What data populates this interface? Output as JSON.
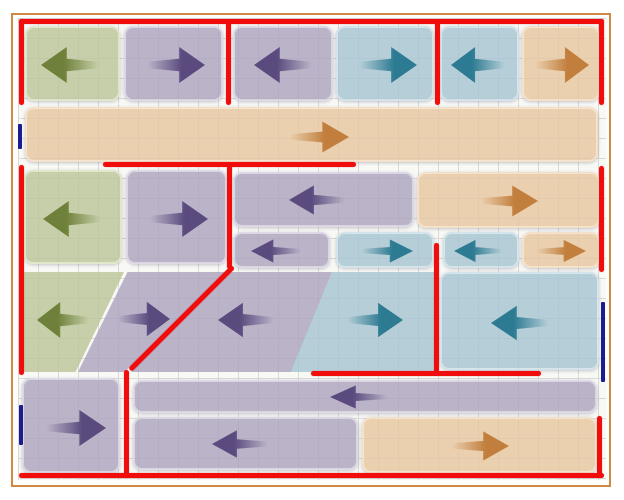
{
  "diagram": {
    "canvas": {
      "width": 624,
      "height": 500,
      "background": "#ffffff"
    },
    "frame": {
      "x": 11,
      "y": 13,
      "w": 600,
      "h": 474,
      "border_width": 2,
      "border_color": "#d08845",
      "fill": "#fdfdfb"
    },
    "grid": {
      "x": 18,
      "y": 18,
      "w": 588,
      "h": 462,
      "cell": 20,
      "line_color": "#d9d9d6",
      "background": "#f8f8f5"
    },
    "palette": {
      "green": {
        "fill": "rgba(187,198,152,0.82)",
        "edge": "rgba(226,236,202,0.95)",
        "arrow": "#6e8039"
      },
      "purple": {
        "fill": "rgba(173,163,190,0.82)",
        "edge": "rgba(224,220,234,0.95)",
        "arrow": "#5a4a7e"
      },
      "teal": {
        "fill": "rgba(167,197,210,0.82)",
        "edge": "rgba(211,230,236,0.95)",
        "arrow": "#2d7b92"
      },
      "orange": {
        "fill": "rgba(231,199,160,0.82)",
        "edge": "rgba(244,224,198,0.95)",
        "arrow": "#c17e3c"
      }
    },
    "line_colors": {
      "red": "#f20d0d",
      "blue": "#1c1c92"
    },
    "tiles": [
      {
        "id": "r1c1",
        "color": "green",
        "dir": "left",
        "x": 25,
        "y": 26,
        "w": 95,
        "h": 75,
        "arrow": {
          "cx": 70,
          "cy": 64,
          "w": 60,
          "h": 42
        }
      },
      {
        "id": "r1c2",
        "color": "purple",
        "dir": "right",
        "x": 124,
        "y": 26,
        "w": 99,
        "h": 75,
        "arrow": {
          "cx": 174,
          "cy": 64,
          "w": 60,
          "h": 42
        }
      },
      {
        "id": "r1c3",
        "color": "purple",
        "dir": "left",
        "x": 233,
        "y": 26,
        "w": 100,
        "h": 75,
        "arrow": {
          "cx": 283,
          "cy": 64,
          "w": 60,
          "h": 42
        }
      },
      {
        "id": "r1c4",
        "color": "teal",
        "dir": "right",
        "x": 336,
        "y": 26,
        "w": 98,
        "h": 75,
        "arrow": {
          "cx": 386,
          "cy": 64,
          "w": 60,
          "h": 42
        }
      },
      {
        "id": "r1c5",
        "color": "teal",
        "dir": "left",
        "x": 440,
        "y": 26,
        "w": 79,
        "h": 75,
        "arrow": {
          "cx": 478,
          "cy": 64,
          "w": 56,
          "h": 42
        }
      },
      {
        "id": "r1c6",
        "color": "orange",
        "dir": "right",
        "x": 522,
        "y": 26,
        "w": 78,
        "h": 75,
        "arrow": {
          "cx": 560,
          "cy": 64,
          "w": 56,
          "h": 42
        }
      },
      {
        "id": "r2-band",
        "color": "orange",
        "dir": "right",
        "x": 25,
        "y": 107,
        "w": 573,
        "h": 55,
        "arrow": {
          "cx": 317,
          "cy": 136,
          "w": 62,
          "h": 36
        }
      },
      {
        "id": "r3c1",
        "color": "green",
        "dir": "left",
        "x": 24,
        "y": 170,
        "w": 98,
        "h": 94,
        "arrow": {
          "cx": 72,
          "cy": 218,
          "w": 60,
          "h": 42
        }
      },
      {
        "id": "r3c2",
        "color": "purple",
        "dir": "right",
        "x": 126,
        "y": 170,
        "w": 101,
        "h": 94,
        "arrow": {
          "cx": 177,
          "cy": 218,
          "w": 60,
          "h": 42
        }
      },
      {
        "id": "r3-wide-purple",
        "color": "purple",
        "dir": "left",
        "x": 233,
        "y": 172,
        "w": 181,
        "h": 55,
        "arrow": {
          "cx": 317,
          "cy": 199,
          "w": 58,
          "h": 34
        }
      },
      {
        "id": "r3-wide-orange",
        "color": "orange",
        "dir": "right",
        "x": 417,
        "y": 172,
        "w": 183,
        "h": 56,
        "arrow": {
          "cx": 507,
          "cy": 200,
          "w": 60,
          "h": 36
        }
      },
      {
        "id": "r3s1",
        "color": "purple",
        "dir": "left",
        "x": 233,
        "y": 232,
        "w": 97,
        "h": 36,
        "arrow": {
          "cx": 276,
          "cy": 250,
          "w": 52,
          "h": 27
        }
      },
      {
        "id": "r3s2",
        "color": "teal",
        "dir": "right",
        "x": 336,
        "y": 232,
        "w": 98,
        "h": 36,
        "arrow": {
          "cx": 385,
          "cy": 250,
          "w": 54,
          "h": 27
        }
      },
      {
        "id": "r3s3",
        "color": "teal",
        "dir": "left",
        "x": 443,
        "y": 232,
        "w": 76,
        "h": 36,
        "arrow": {
          "cx": 478,
          "cy": 250,
          "w": 50,
          "h": 26
        }
      },
      {
        "id": "r3s4",
        "color": "orange",
        "dir": "right",
        "x": 522,
        "y": 232,
        "w": 78,
        "h": 36,
        "arrow": {
          "cx": 559,
          "cy": 250,
          "w": 52,
          "h": 26
        }
      },
      {
        "id": "r4-green-trapezoid",
        "color": "green",
        "dir": "left",
        "x": 23,
        "y": 272,
        "w": 101,
        "h": 100,
        "clip": "polygon(0% 0%, 100% 0%, 52% 100%, 0% 100%)",
        "arrow": {
          "cx": 64,
          "cy": 320,
          "w": 54,
          "h": 42
        }
      },
      {
        "id": "r4-purple-parallelogram",
        "color": "purple",
        "dir": "right",
        "x": 78,
        "y": 272,
        "w": 150,
        "h": 100,
        "clip": "polygon(33% 0%, 100% 0%, 31% 100%, 0% 100%)",
        "arrow": {
          "cx": 143,
          "cy": 319,
          "w": 54,
          "h": 40
        }
      },
      {
        "id": "r4-purple-slant",
        "color": "purple",
        "dir": "left",
        "x": 127,
        "y": 272,
        "w": 205,
        "h": 100,
        "clip": "polygon(51% 0%, 100% 0%, 80% 100%, 2% 100%)",
        "arrow": {
          "cx": 247,
          "cy": 320,
          "w": 58,
          "h": 40
        }
      },
      {
        "id": "r4-teal-trapezoid",
        "color": "teal",
        "dir": "right",
        "x": 290,
        "y": 272,
        "w": 145,
        "h": 100,
        "clip": "polygon(29% 0%, 100% 0%, 100% 100%, 0% 100%)",
        "arrow": {
          "cx": 374,
          "cy": 320,
          "w": 58,
          "h": 40
        }
      },
      {
        "id": "r4-teal-right",
        "color": "teal",
        "dir": "left",
        "x": 440,
        "y": 272,
        "w": 159,
        "h": 98,
        "arrow": {
          "cx": 520,
          "cy": 322,
          "w": 60,
          "h": 40
        }
      },
      {
        "id": "r5-left",
        "color": "purple",
        "dir": "right",
        "x": 22,
        "y": 378,
        "w": 98,
        "h": 95,
        "arrow": {
          "cx": 74,
          "cy": 427,
          "w": 62,
          "h": 42
        }
      },
      {
        "id": "r5-band-top",
        "color": "purple",
        "dir": "left",
        "x": 133,
        "y": 380,
        "w": 464,
        "h": 33,
        "arrow": {
          "cx": 359,
          "cy": 396,
          "w": 60,
          "h": 27
        }
      },
      {
        "id": "r5-band-bottom-purple",
        "color": "purple",
        "dir": "left",
        "x": 133,
        "y": 417,
        "w": 225,
        "h": 53,
        "arrow": {
          "cx": 240,
          "cy": 443,
          "w": 58,
          "h": 32
        }
      },
      {
        "id": "r5-band-bottom-orange",
        "color": "orange",
        "dir": "right",
        "x": 362,
        "y": 417,
        "w": 235,
        "h": 56,
        "arrow": {
          "cx": 478,
          "cy": 445,
          "w": 60,
          "h": 34
        }
      }
    ],
    "red_lines": [
      {
        "id": "top-border",
        "x": 19,
        "y": 19,
        "w": 585,
        "h": 5
      },
      {
        "id": "left-upper",
        "x": 19,
        "y": 19,
        "w": 5,
        "h": 86
      },
      {
        "id": "right-upper",
        "x": 599,
        "y": 19,
        "w": 5,
        "h": 86
      },
      {
        "id": "row1-divider-a",
        "x": 226,
        "y": 21,
        "w": 5,
        "h": 84
      },
      {
        "id": "row1-divider-b",
        "x": 435,
        "y": 21,
        "w": 5,
        "h": 84
      },
      {
        "id": "mid-horizontal",
        "x": 103,
        "y": 162,
        "w": 253,
        "h": 5
      },
      {
        "id": "left-middle",
        "x": 19,
        "y": 165,
        "w": 5,
        "h": 210
      },
      {
        "id": "right-middle",
        "x": 599,
        "y": 166,
        "w": 5,
        "h": 106
      },
      {
        "id": "row3-divider",
        "x": 227,
        "y": 165,
        "w": 5,
        "h": 104
      },
      {
        "id": "diagonal",
        "x": 229,
        "y": 266,
        "w": 146,
        "h": 5,
        "angle": 135
      },
      {
        "id": "left-lower-vert",
        "x": 124,
        "y": 370,
        "w": 5,
        "h": 108
      },
      {
        "id": "mid-vert-lower",
        "x": 434,
        "y": 243,
        "w": 5,
        "h": 132
      },
      {
        "id": "row4-horizontal",
        "x": 311,
        "y": 371,
        "w": 230,
        "h": 5
      },
      {
        "id": "bottom-border",
        "x": 19,
        "y": 473,
        "w": 585,
        "h": 5
      },
      {
        "id": "right-lower",
        "x": 597,
        "y": 416,
        "w": 5,
        "h": 62
      }
    ],
    "blue_marks": [
      {
        "id": "left-mark-upper",
        "x": 18,
        "y": 124,
        "w": 4,
        "h": 25
      },
      {
        "id": "left-mark-lower",
        "x": 19,
        "y": 405,
        "w": 4,
        "h": 40
      },
      {
        "id": "right-mark",
        "x": 601,
        "y": 302,
        "w": 4,
        "h": 80
      }
    ]
  }
}
